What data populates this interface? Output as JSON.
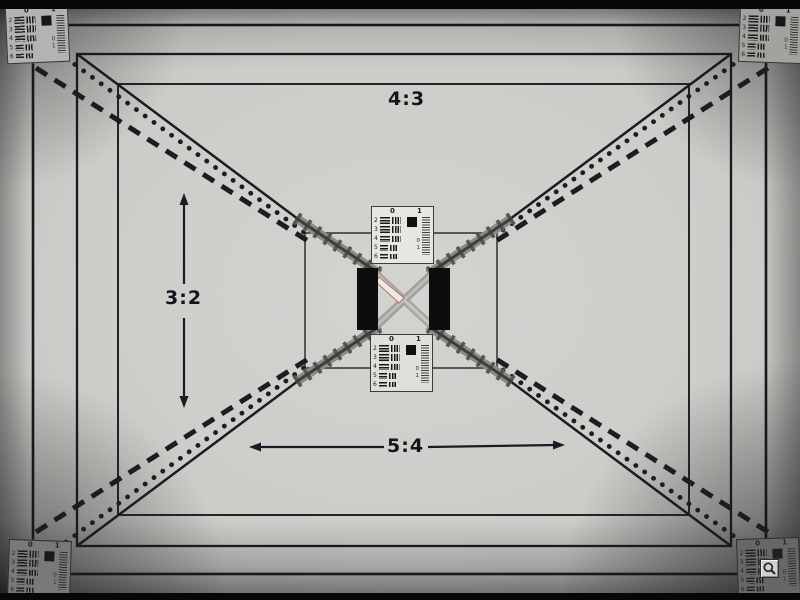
{
  "photo": {
    "description": "camera test-chart photograph",
    "aspect_labels": {
      "top": "4:3",
      "left": "3:2",
      "bottom": "5:4"
    }
  },
  "card_pattern": {
    "group_labels": [
      "0",
      "1"
    ],
    "row_numbers": [
      "2",
      "3",
      "4",
      "5",
      "6"
    ],
    "corner_labels": [
      "0",
      "1"
    ]
  },
  "cards": {
    "instances": [
      {
        "id": "top-left",
        "name": "resolution-target-top-left"
      },
      {
        "id": "top-right",
        "name": "resolution-target-top-right"
      },
      {
        "id": "bottom-left",
        "name": "resolution-target-bottom-left"
      },
      {
        "id": "bottom-right",
        "name": "resolution-target-bottom-right"
      },
      {
        "id": "center-upper",
        "name": "resolution-target-center-upper"
      },
      {
        "id": "center-lower",
        "name": "resolution-target-center-lower"
      }
    ]
  },
  "controls": {
    "zoom_button": {
      "icon": "magnifier-icon"
    }
  },
  "palette": {
    "chart_background": "#d4d3d0",
    "line_color": "#17171d",
    "card_background": "#e7e6e2",
    "black_bar": "#0d0d0d",
    "cross_highlight": "#efe9e3",
    "cross_highlight_edge": "#b4766a",
    "vignette_corner": "#5e5d5b"
  }
}
